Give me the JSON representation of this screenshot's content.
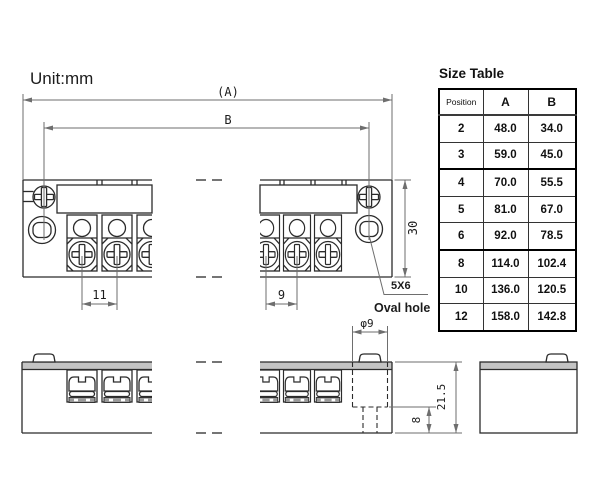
{
  "unit_label": "Unit:mm",
  "drawing": {
    "dims": {
      "overall_length": "(A)",
      "mount_pitch": "B",
      "body_width": "30",
      "pitch_left": "11",
      "pitch_right": "9",
      "boss_dia": "φ9",
      "body_height": "21.5",
      "boss_depth": "8"
    },
    "notes": {
      "hole_size": "5X6",
      "hole_type": "Oval hole"
    }
  },
  "size_table": {
    "title": "Size Table",
    "headers": [
      "Position",
      "A",
      "B"
    ],
    "rows": [
      [
        "2",
        "48.0",
        "34.0"
      ],
      [
        "3",
        "59.0",
        "45.0"
      ],
      [
        "4",
        "70.0",
        "55.5"
      ],
      [
        "5",
        "81.0",
        "67.0"
      ],
      [
        "6",
        "92.0",
        "78.5"
      ],
      [
        "8",
        "114.0",
        "102.4"
      ],
      [
        "10",
        "136.0",
        "120.5"
      ],
      [
        "12",
        "158.0",
        "142.8"
      ]
    ]
  },
  "colors": {
    "object_line": "#2b2b2b",
    "dimension_line": "#6e6e6e",
    "top_band": "#c4c4c4",
    "table_border": "#000000",
    "background": "#ffffff"
  }
}
